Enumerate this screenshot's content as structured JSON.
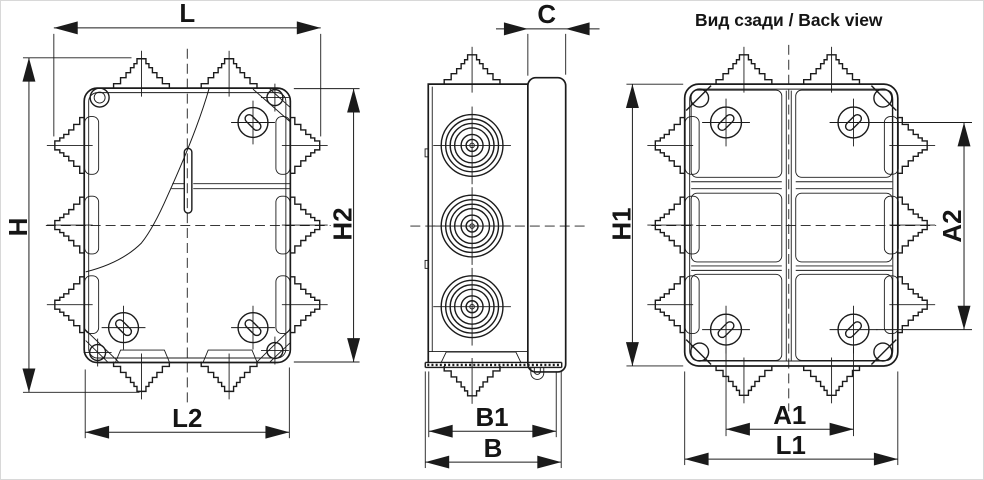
{
  "back_view_title": "Вид сзади / Back view",
  "dimensions": {
    "L": "L",
    "H": "H",
    "H2": "H2",
    "L2": "L2",
    "C": "C",
    "B1": "B1",
    "B": "B",
    "H1": "H1",
    "A2": "A2",
    "A1": "A1",
    "L1": "L1"
  },
  "colors": {
    "line": "#1b1b1b",
    "background": "#ffffff",
    "border": "#d8d8d8"
  }
}
